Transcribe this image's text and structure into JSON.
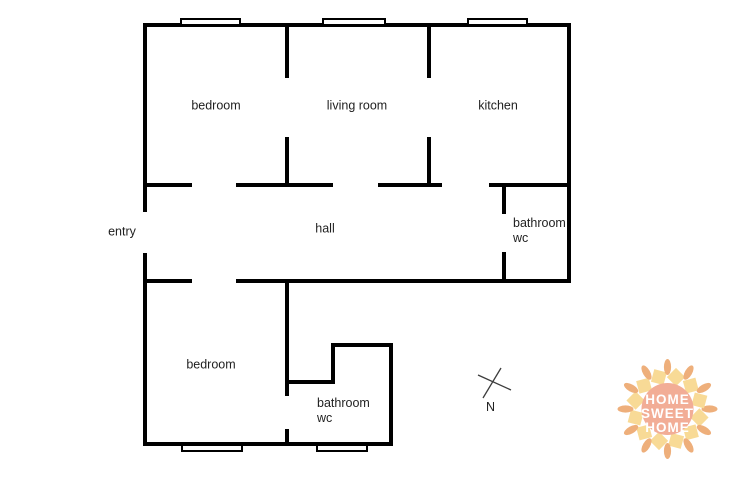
{
  "page": {
    "background": "#ffffff"
  },
  "plan": {
    "wall_color": "#000000",
    "label_color": "#1f1f1f",
    "walls": [
      {
        "x": 143,
        "y": 23,
        "w": 428,
        "h": 4
      },
      {
        "x": 143,
        "y": 183,
        "w": 49,
        "h": 4
      },
      {
        "x": 236,
        "y": 183,
        "w": 97,
        "h": 4
      },
      {
        "x": 378,
        "y": 183,
        "w": 64,
        "h": 4
      },
      {
        "x": 489,
        "y": 183,
        "w": 82,
        "h": 4
      },
      {
        "x": 143,
        "y": 279,
        "w": 49,
        "h": 4
      },
      {
        "x": 236,
        "y": 279,
        "w": 335,
        "h": 4
      },
      {
        "x": 331,
        "y": 343,
        "w": 62,
        "h": 4
      },
      {
        "x": 285,
        "y": 380,
        "w": 50,
        "h": 4
      },
      {
        "x": 143,
        "y": 442,
        "w": 250,
        "h": 4
      },
      {
        "x": 143,
        "y": 23,
        "w": 4,
        "h": 189
      },
      {
        "x": 143,
        "y": 253,
        "w": 4,
        "h": 193
      },
      {
        "x": 567,
        "y": 23,
        "w": 4,
        "h": 260
      },
      {
        "x": 285,
        "y": 23,
        "w": 4,
        "h": 55
      },
      {
        "x": 285,
        "y": 137,
        "w": 4,
        "h": 50
      },
      {
        "x": 427,
        "y": 23,
        "w": 4,
        "h": 55
      },
      {
        "x": 427,
        "y": 137,
        "w": 4,
        "h": 50
      },
      {
        "x": 502,
        "y": 183,
        "w": 4,
        "h": 31
      },
      {
        "x": 502,
        "y": 252,
        "w": 4,
        "h": 31
      },
      {
        "x": 285,
        "y": 279,
        "w": 4,
        "h": 117
      },
      {
        "x": 285,
        "y": 429,
        "w": 4,
        "h": 17
      },
      {
        "x": 389,
        "y": 343,
        "w": 4,
        "h": 103
      },
      {
        "x": 331,
        "y": 343,
        "w": 4,
        "h": 41
      }
    ],
    "windows": [
      {
        "x": 180,
        "y": 18,
        "w": 61,
        "h": 8
      },
      {
        "x": 322,
        "y": 18,
        "w": 64,
        "h": 8
      },
      {
        "x": 467,
        "y": 18,
        "w": 61,
        "h": 8
      },
      {
        "x": 181,
        "y": 444,
        "w": 62,
        "h": 8
      },
      {
        "x": 316,
        "y": 444,
        "w": 52,
        "h": 8
      }
    ],
    "rooms": [
      {
        "id": "bedroom-top",
        "lines": [
          "bedroom"
        ],
        "x": 216,
        "y": 106,
        "align": "center"
      },
      {
        "id": "living-room",
        "lines": [
          "living room"
        ],
        "x": 357,
        "y": 106,
        "align": "center"
      },
      {
        "id": "kitchen",
        "lines": [
          "kitchen"
        ],
        "x": 498,
        "y": 106,
        "align": "center"
      },
      {
        "id": "entry",
        "lines": [
          "entry"
        ],
        "x": 122,
        "y": 232,
        "align": "center"
      },
      {
        "id": "hall",
        "lines": [
          "hall"
        ],
        "x": 325,
        "y": 229,
        "align": "center"
      },
      {
        "id": "bathroom-top",
        "lines": [
          "bathroom",
          "wc"
        ],
        "x": 513,
        "y": 216,
        "align": "left"
      },
      {
        "id": "bedroom-bottom",
        "lines": [
          "bedroom"
        ],
        "x": 211,
        "y": 365,
        "align": "center"
      },
      {
        "id": "bathroom-bottom",
        "lines": [
          "bathroom",
          "wc"
        ],
        "x": 317,
        "y": 396,
        "align": "left"
      }
    ]
  },
  "compass": {
    "label": "N"
  },
  "logo": {
    "lines": [
      "HOME",
      "SWEET",
      "HOME"
    ],
    "circle_color": "#f2a78f",
    "diamond_color": "#f8d88f",
    "sprig_color": "#edaa72",
    "text_color": "#ffffff"
  }
}
